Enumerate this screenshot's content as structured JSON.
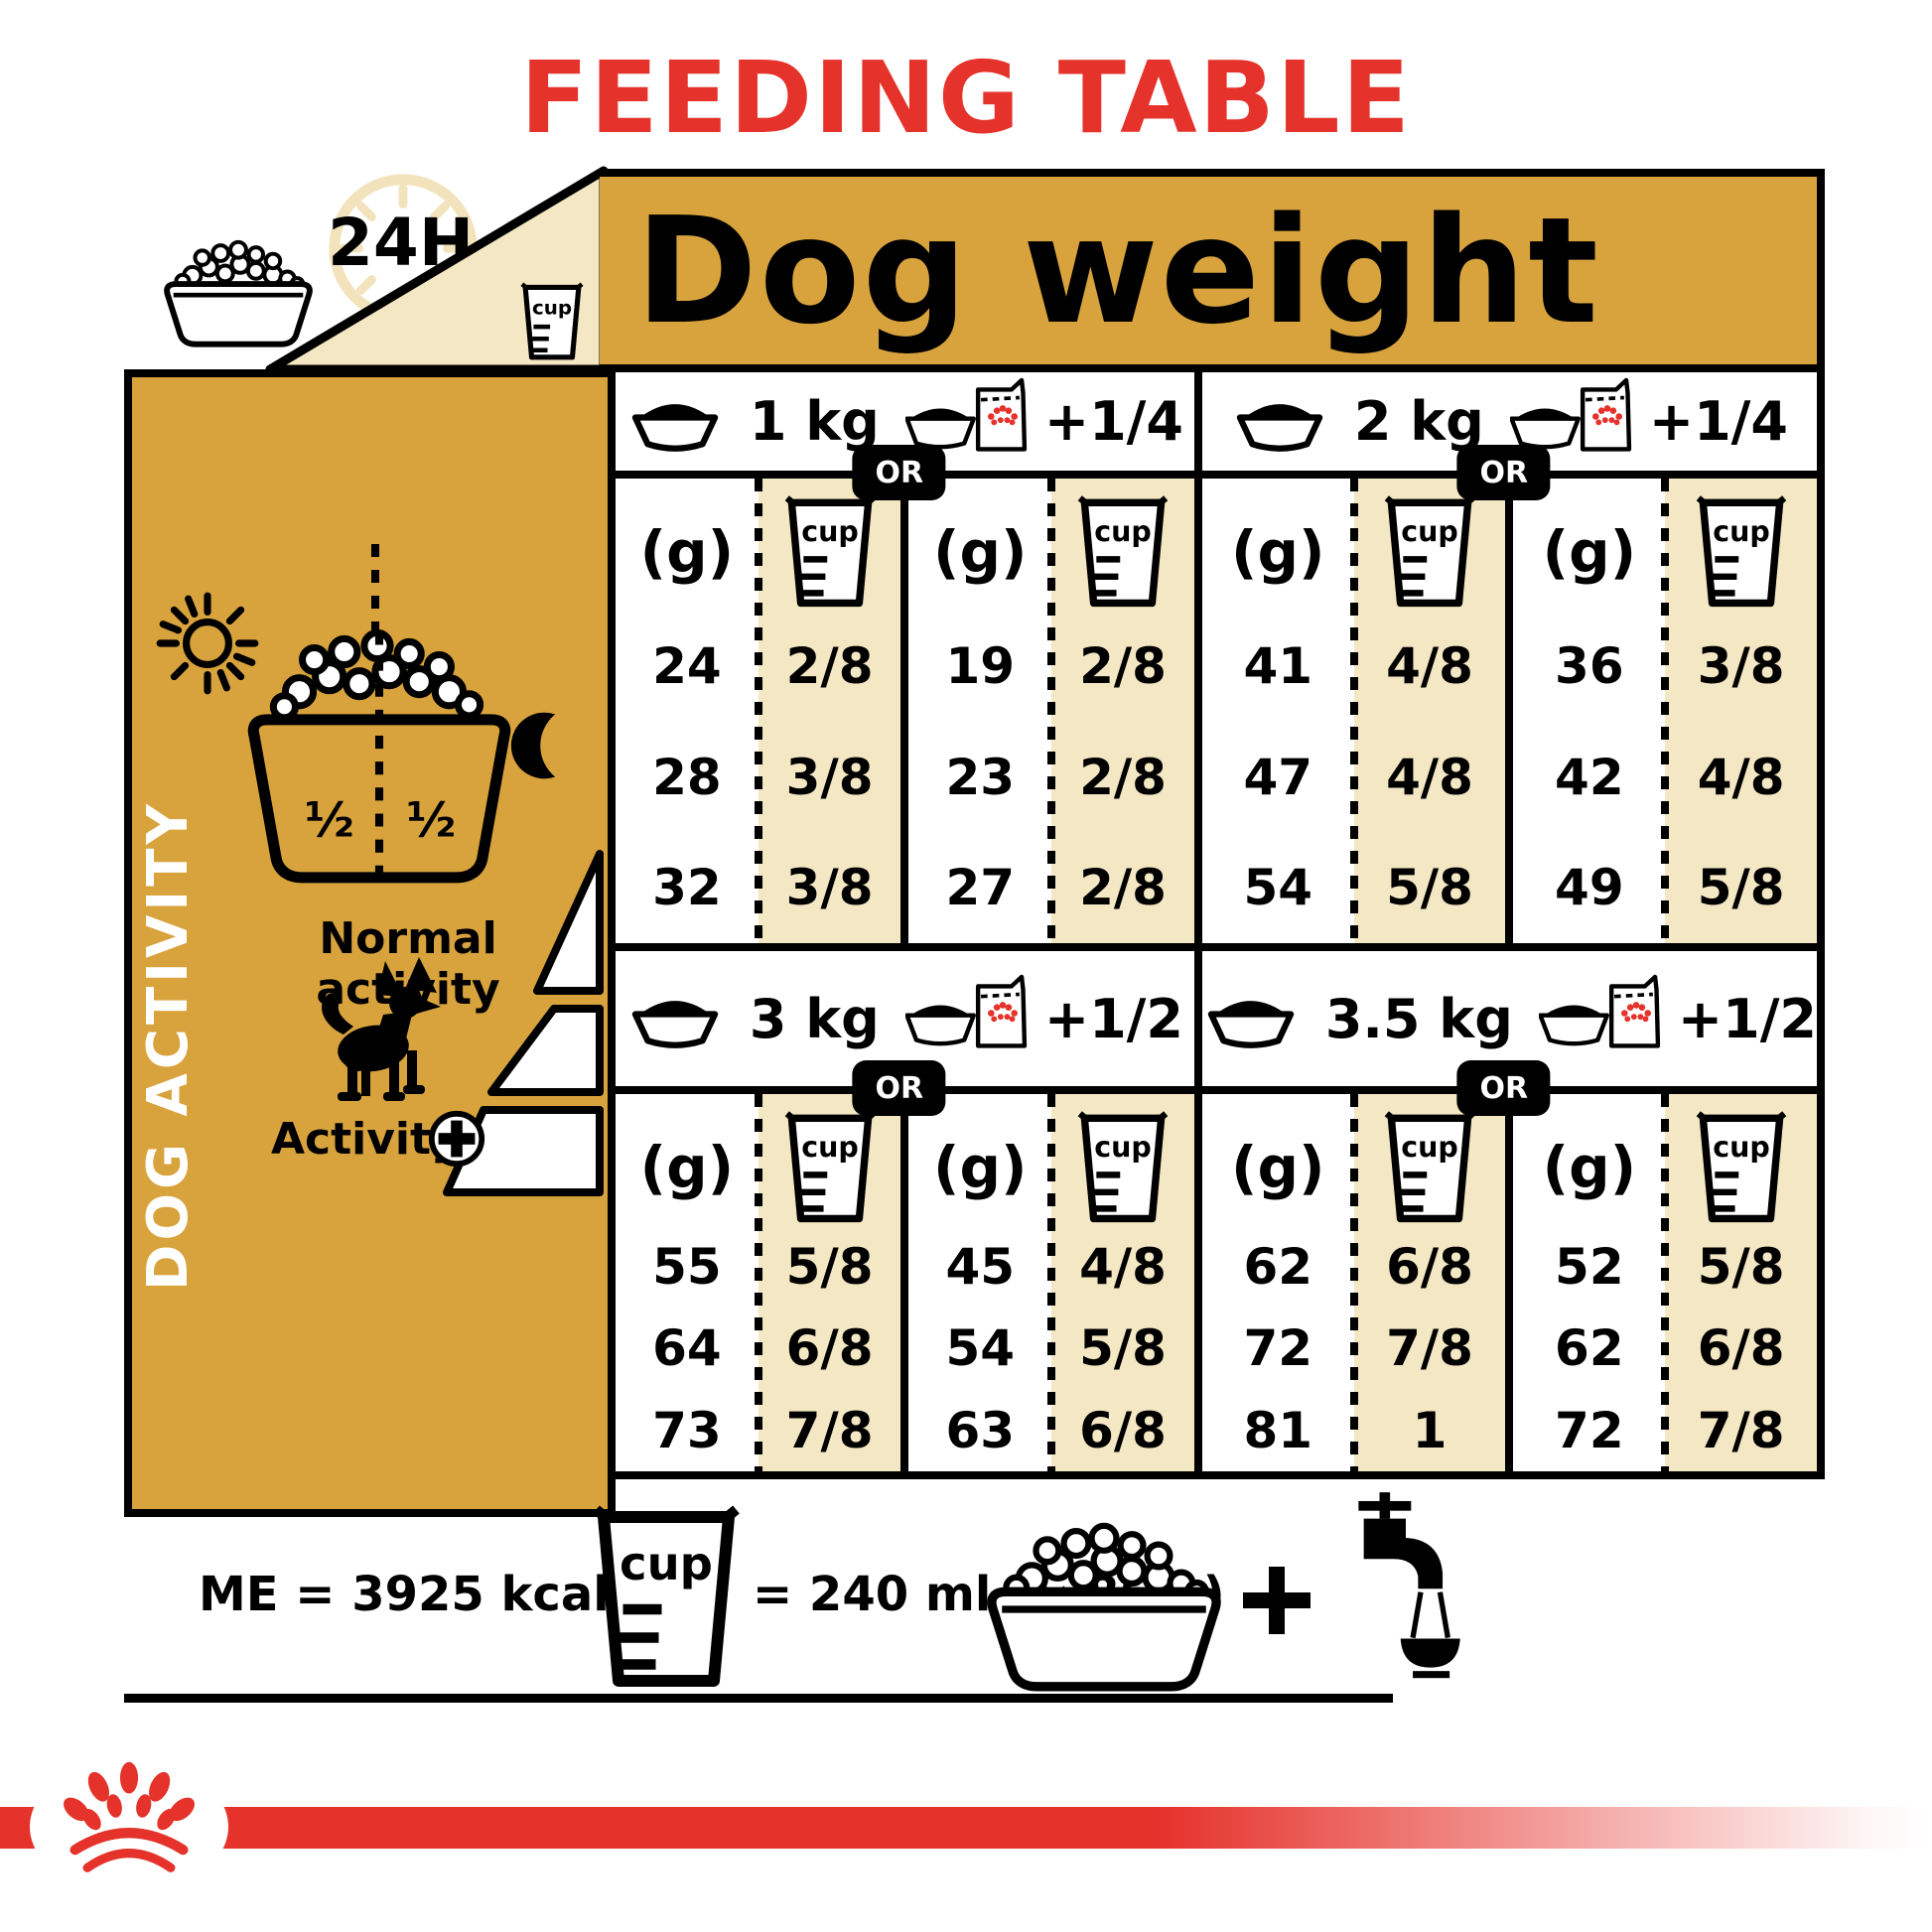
{
  "title": "FEEDING TABLE",
  "banner": {
    "dog_weight": "Dog weight",
    "hours": "24H"
  },
  "labels": {
    "or": "OR",
    "grams": "(g)",
    "cup": "cup",
    "half": "½"
  },
  "sidebar": {
    "vertical_title": "DOG ACTIVITY",
    "normal_activity": "Normal activity",
    "activity": "Activity"
  },
  "quadrants": [
    {
      "weight": "1 kg",
      "wet_add": "+1/4",
      "rows": [
        {
          "dry_g": "24",
          "dry_cup": "2/8",
          "mix_g": "19",
          "mix_cup": "2/8"
        },
        {
          "dry_g": "28",
          "dry_cup": "3/8",
          "mix_g": "23",
          "mix_cup": "2/8"
        },
        {
          "dry_g": "32",
          "dry_cup": "3/8",
          "mix_g": "27",
          "mix_cup": "2/8"
        }
      ]
    },
    {
      "weight": "2 kg",
      "wet_add": "+1/4",
      "rows": [
        {
          "dry_g": "41",
          "dry_cup": "4/8",
          "mix_g": "36",
          "mix_cup": "3/8"
        },
        {
          "dry_g": "47",
          "dry_cup": "4/8",
          "mix_g": "42",
          "mix_cup": "4/8"
        },
        {
          "dry_g": "54",
          "dry_cup": "5/8",
          "mix_g": "49",
          "mix_cup": "5/8"
        }
      ]
    },
    {
      "weight": "3 kg",
      "wet_add": "+1/2",
      "rows": [
        {
          "dry_g": "55",
          "dry_cup": "5/8",
          "mix_g": "45",
          "mix_cup": "4/8"
        },
        {
          "dry_g": "64",
          "dry_cup": "6/8",
          "mix_g": "54",
          "mix_cup": "5/8"
        },
        {
          "dry_g": "73",
          "dry_cup": "7/8",
          "mix_g": "63",
          "mix_cup": "6/8"
        }
      ]
    },
    {
      "weight": "3.5 kg",
      "wet_add": "+1/2",
      "rows": [
        {
          "dry_g": "62",
          "dry_cup": "6/8",
          "mix_g": "52",
          "mix_cup": "5/8"
        },
        {
          "dry_g": "72",
          "dry_cup": "7/8",
          "mix_g": "62",
          "mix_cup": "6/8"
        },
        {
          "dry_g": "81",
          "dry_cup": "1",
          "mix_g": "72",
          "mix_cup": "7/8"
        }
      ]
    }
  ],
  "footer": {
    "me": "ME = 3925 kcal/kg",
    "cup_equiv": "= 240 ml (≃ 86 g)",
    "plus": "+"
  },
  "colors": {
    "gold": "#d8a33c",
    "cream": "#f4e7c3",
    "red": "#e5322b",
    "black": "#000000",
    "clock_tan": "#f3e3bd"
  },
  "icons": [
    "kibble-bowl-icon",
    "clock-24h-icon",
    "measuring-cup-icon",
    "dry-bowl-icon",
    "wet-pouch-bowl-icon",
    "sun-icon",
    "moon-icon",
    "chihuahua-icon",
    "activity-plus-icon",
    "activity-ramp-icon",
    "water-tap-icon",
    "plus-icon",
    "royal-canin-crown-icon"
  ]
}
